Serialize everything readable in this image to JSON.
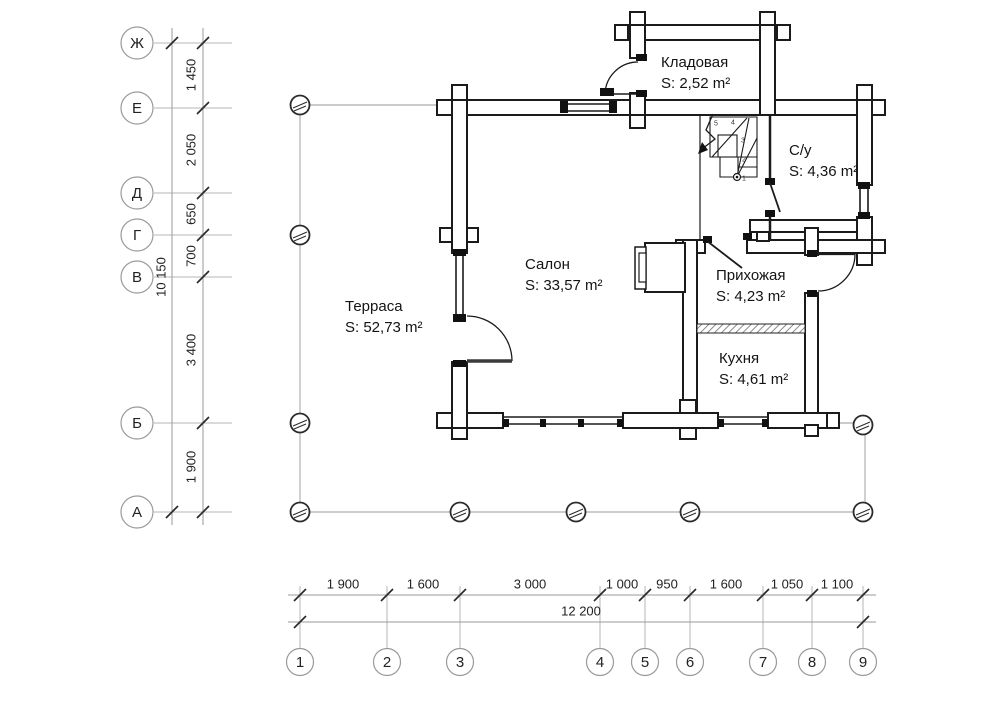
{
  "grid": {
    "rows": [
      "Ж",
      "Е",
      "Д",
      "Г",
      "В",
      "Б",
      "А"
    ],
    "columns": [
      "1",
      "2",
      "3",
      "4",
      "5",
      "6",
      "7",
      "8",
      "9"
    ]
  },
  "dims_left": {
    "segments": [
      "1 450",
      "2 050",
      "650",
      "700",
      "3 400",
      "1 900"
    ],
    "total": "10 150"
  },
  "dims_bottom": {
    "segments": [
      "1 900",
      "1 600",
      "3 000",
      "1 000",
      "950",
      "1 600",
      "1 050",
      "1 100"
    ],
    "total": "12 200"
  },
  "rooms": [
    {
      "name": "Терраса",
      "area": "S: 52,73 m²"
    },
    {
      "name": "Салон",
      "area": "S: 33,57 m²"
    },
    {
      "name": "Кладовая",
      "area": "S: 2,52 m²"
    },
    {
      "name": "С/у",
      "area": "S: 4,36 m²"
    },
    {
      "name": "Прихожая",
      "area": "S: 4,23 m²"
    },
    {
      "name": "Кухня",
      "area": "S: 4,61 m²"
    }
  ],
  "stairs": {
    "steps": [
      "1",
      "2",
      "3",
      "4",
      "5"
    ]
  },
  "colors": {
    "wall": "#1b1b1b",
    "grid_line": "#9a9a9a",
    "terrace_line": "#bcbcbc",
    "text": "#222222"
  }
}
